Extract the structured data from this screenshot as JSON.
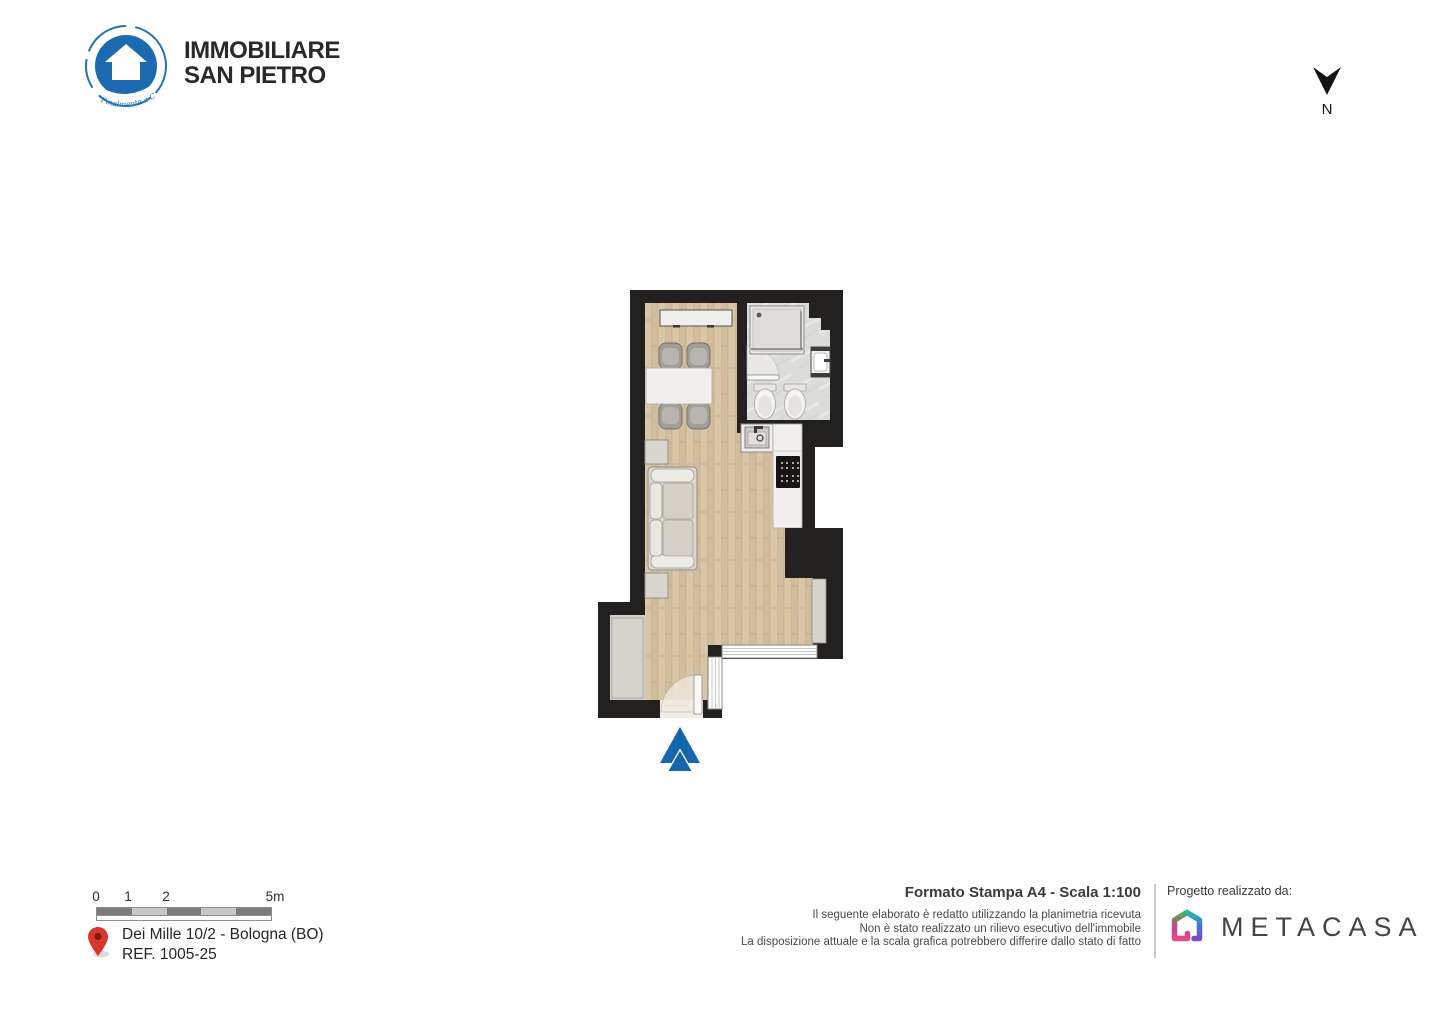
{
  "branding": {
    "name_line1": "IMMOBILIARE",
    "name_line2": "SAN PIETRO",
    "tagline": "Finalmente a Casa",
    "logo_icon": "house-in-circle-icon",
    "logo_color": "#1b6ab0"
  },
  "compass": {
    "label": "N",
    "icon": "north-arrow-icon"
  },
  "floorplan": {
    "rooms": [
      "living-dining-kitchen",
      "bathroom",
      "entrance"
    ],
    "furniture": [
      "sideboard",
      "dining-table",
      "chairs",
      "sofa",
      "side-tables",
      "kitchen-sink",
      "cooktop",
      "shower",
      "bathroom-sink",
      "bidet",
      "toilet",
      "wardrobe"
    ],
    "entrance_marker": "entrance-arrow-icon",
    "entrance_marker_color": "#1566ac",
    "wall_color": "#232120",
    "wood_floor_color": "#d9c6a7",
    "tile_floor_color": "#dcdcda"
  },
  "scale_bar": {
    "ticks": [
      "0",
      "1",
      "2",
      "5m"
    ]
  },
  "location": {
    "pin_icon": "location-pin-icon",
    "address": "Dei Mille 10/2 - Bologna (BO)",
    "reference": "REF. 1005-25"
  },
  "print_info": {
    "title": "Formato Stampa A4 - Scala 1:100",
    "disclaimer": [
      "Il seguente elaborato è redatto utilizzando la planimetria ricevuta",
      "Non è stato realizzato un rilievo esecutivo dell'immobile",
      "La disposizione attuale e la scala grafica potrebbero differire dallo stato di fatto"
    ]
  },
  "credits": {
    "label": "Progetto realizzato da:",
    "company": "METACASA",
    "icon": "metacasa-house-icon"
  }
}
